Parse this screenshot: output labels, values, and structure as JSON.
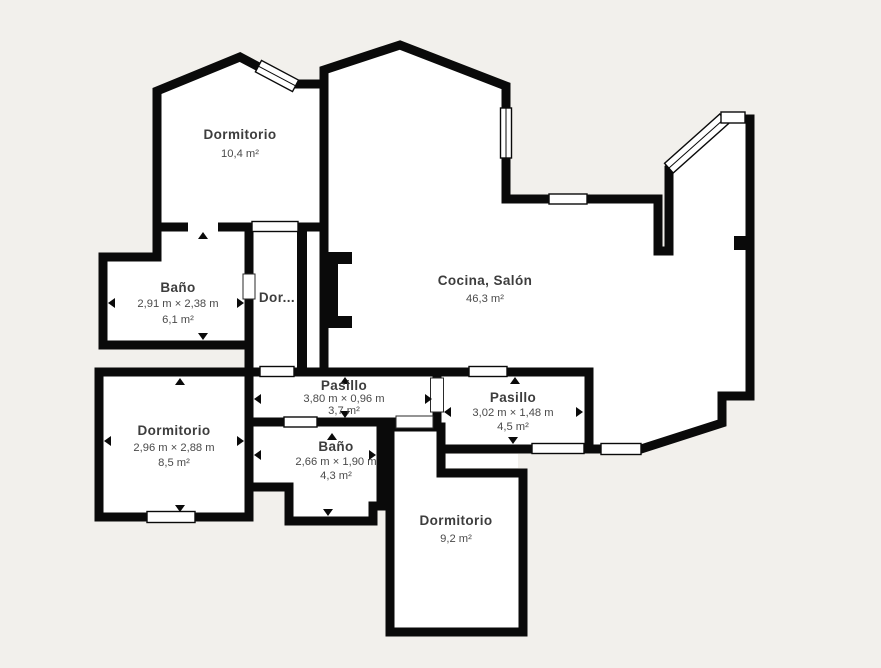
{
  "floorplan": {
    "background_color": "#f2f0ec",
    "wall_color": "#0a0a0a",
    "room_fill": "#ffffff",
    "text_color": "#3d3d3d",
    "rooms": [
      {
        "name": "Dormitorio",
        "area": "10,4 m²"
      },
      {
        "name": "Cocina, Salón",
        "area": "46,3 m²"
      },
      {
        "name": "Baño",
        "dimensions": "2,91 m × 2,38 m",
        "area": "6,1 m²"
      },
      {
        "name": "Dor..."
      },
      {
        "name": "Pasillo",
        "dimensions": "3,80 m × 0,96 m",
        "area": "3,7 m²"
      },
      {
        "name": "Pasillo",
        "dimensions": "3,02 m × 1,48 m",
        "area": "4,5 m²"
      },
      {
        "name": "Dormitorio",
        "dimensions": "2,96 m × 2,88 m",
        "area": "8,5 m²"
      },
      {
        "name": "Baño",
        "dimensions": "2,66 m × 1,90 m",
        "area": "4,3 m²"
      },
      {
        "name": "Dormitorio",
        "area": "9,2 m²"
      }
    ]
  }
}
